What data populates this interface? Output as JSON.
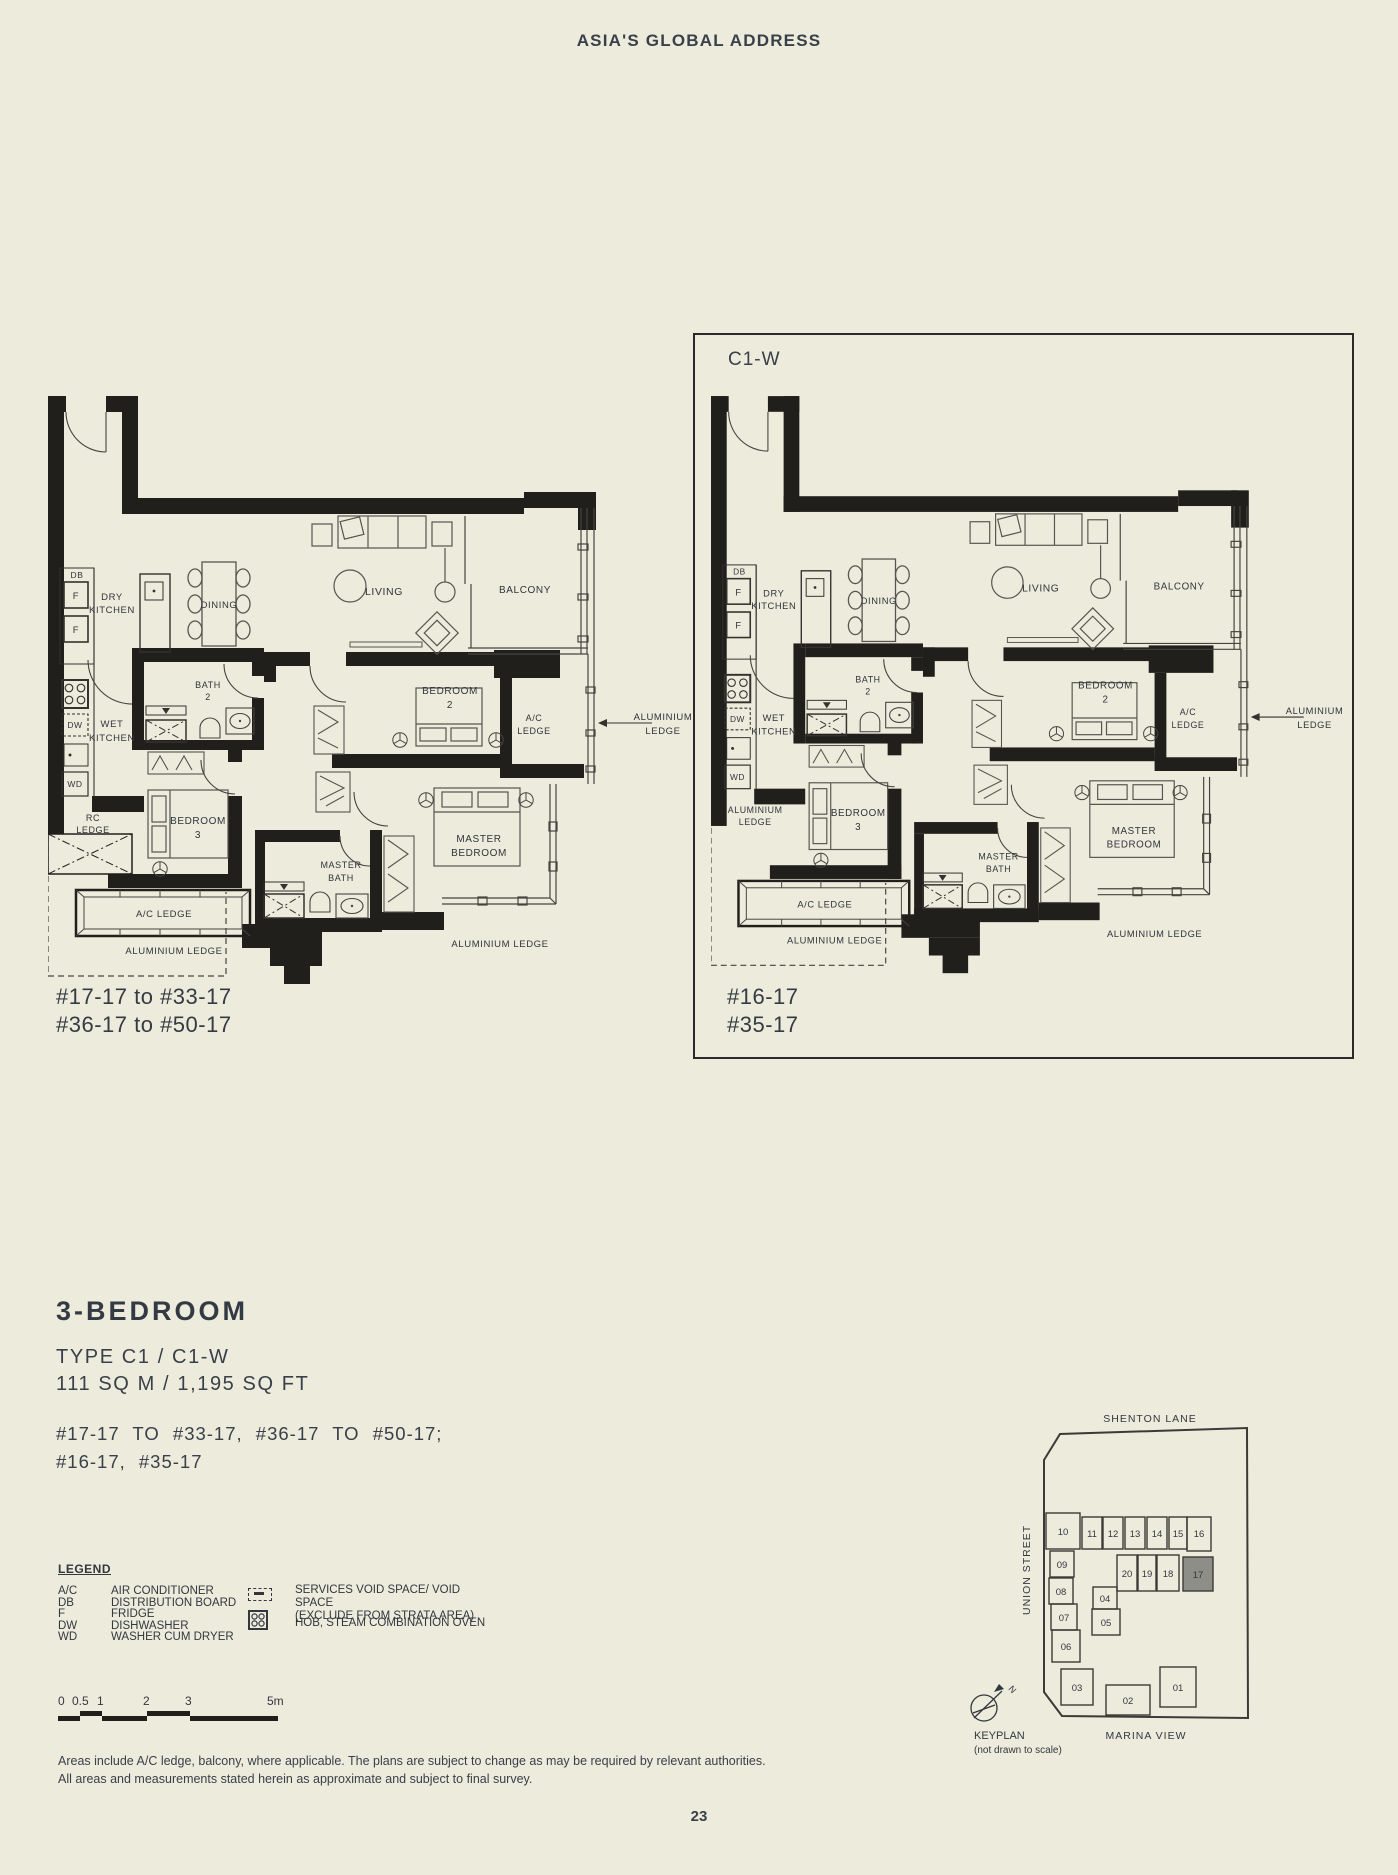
{
  "header": {
    "title": "ASIA'S GLOBAL ADDRESS"
  },
  "plan_labels": {
    "db": "DB",
    "f": "F",
    "dw": "DW",
    "wd": "WD",
    "dry_kitchen": [
      "DRY",
      "KITCHEN"
    ],
    "wet_kitchen": [
      "WET",
      "KITCHEN"
    ],
    "dining": "DINING",
    "living": "LIVING",
    "balcony": "BALCONY",
    "bath2": [
      "BATH",
      "2"
    ],
    "bedroom2": [
      "BEDROOM",
      "2"
    ],
    "bedroom3": [
      "BEDROOM",
      "3"
    ],
    "master_bedroom": [
      "MASTER",
      "BEDROOM"
    ],
    "master_bath": [
      "MASTER",
      "BATH"
    ],
    "ac_ledge_right": [
      "A/C",
      "LEDGE"
    ],
    "ac_ledge_bottom": "A/C LEDGE",
    "alum_ledge_arrow": [
      "ALUMINIUM",
      "LEDGE"
    ],
    "alum_ledge_bottom_left": "ALUMINIUM LEDGE",
    "alum_ledge_bottom_right": "ALUMINIUM LEDGE"
  },
  "plans": [
    {
      "name": "C1",
      "mid_left_ledge": [
        "RC",
        "LEDGE"
      ],
      "units": [
        "#17-17 to #33-17",
        "#36-17 to #50-17"
      ]
    },
    {
      "name": "C1-W",
      "mid_left_ledge": [
        "ALUMINIUM",
        "LEDGE"
      ],
      "units": [
        "#16-17",
        "#35-17"
      ]
    }
  ],
  "title_block": {
    "title": "3-BEDROOM",
    "type_line": "TYPE C1 / C1-W",
    "area_line": "111 SQ M / 1,195 SQ FT",
    "floors_line1": "#17-17 TO #33-17, #36-17 TO #50-17;",
    "floors_line2": "#16-17, #35-17"
  },
  "legend": {
    "title": "LEGEND",
    "items": [
      {
        "abbr": "A/C",
        "label": "AIR CONDITIONER"
      },
      {
        "abbr": "DB",
        "label": "DISTRIBUTION BOARD"
      },
      {
        "abbr": "F",
        "label": "FRIDGE"
      },
      {
        "abbr": "DW",
        "label": "DISHWASHER"
      },
      {
        "abbr": "WD",
        "label": "WASHER CUM DRYER"
      }
    ],
    "void_icon_label1": "SERVICES VOID SPACE/ VOID SPACE",
    "void_icon_label2": "(EXCLUDE FROM STRATA AREA)",
    "hob_icon_label": "HOB, STEAM COMBINATION OVEN"
  },
  "scale_bar": {
    "labels": [
      "0",
      "0.5",
      "1",
      "2",
      "3",
      "5m"
    ]
  },
  "disclaimer": {
    "line1": "Areas include A/C ledge, balcony, where applicable. The plans are subject to change as may be required by relevant authorities.",
    "line2": "All areas and measurements stated herein as approximate and subject to final survey.",
    "x": ""
  },
  "keyplan": {
    "street_top": "SHENTON LANE",
    "street_left": "UNION STREET",
    "street_bottom": "MARINA VIEW",
    "title": "KEYPLAN",
    "subtitle": "(not drawn to scale)",
    "north": "N",
    "units": [
      "10",
      "11",
      "12",
      "13",
      "14",
      "15",
      "16",
      "09",
      "20",
      "19",
      "18",
      "17",
      "08",
      "04",
      "07",
      "05",
      "06",
      "03",
      "02",
      "01"
    ],
    "highlighted_unit": "17"
  },
  "page_number": "23",
  "colors": {
    "background": "#ECEBDC",
    "ink": "#3A4049",
    "wall": "#211F1C",
    "highlight": "#8E8E89"
  }
}
